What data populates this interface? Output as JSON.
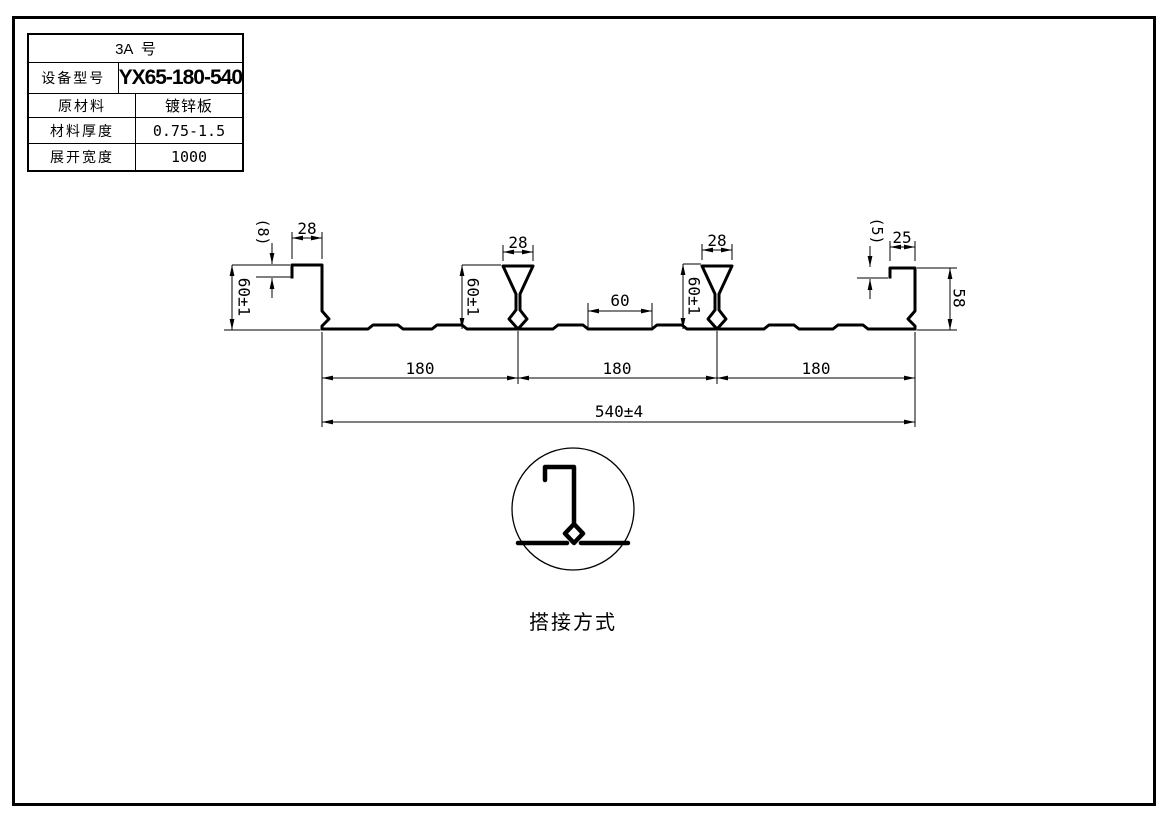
{
  "table": {
    "title": "3A  号",
    "rows": [
      {
        "label": "设备型号",
        "value": "YX65-180-540"
      },
      {
        "label": "原材料",
        "value": "镀锌板"
      },
      {
        "label": "材料厚度",
        "value": "0.75-1.5"
      },
      {
        "label": "展开宽度",
        "value": "1000"
      }
    ]
  },
  "drawing": {
    "dims": {
      "left_lip": "(8)",
      "left_top_width": "28",
      "left_height": "60±1",
      "rib1_top_width": "28",
      "rib1_height": "60±1",
      "mid_flat": "60",
      "rib2_top_width": "28",
      "rib2_height": "60±1",
      "right_lip": "(5)",
      "right_top_width": "25",
      "right_height": "58",
      "pitches": [
        "180",
        "180",
        "180"
      ],
      "overall_width": "540±4"
    },
    "detail": {
      "label": "搭接方式"
    }
  },
  "colors": {
    "line": "#000000",
    "background": "#ffffff"
  }
}
